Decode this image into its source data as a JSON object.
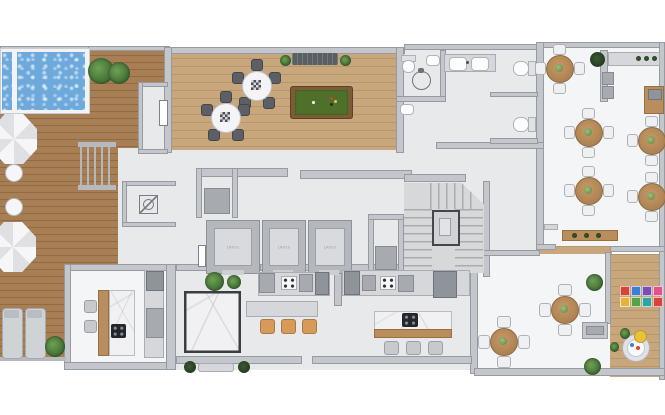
{
  "title": "Residential amenity floor plan",
  "elevator": {
    "label": "LRIOS",
    "count": 3
  },
  "palette": {
    "background": "#ffffff",
    "wall": "#c3c6cb",
    "floor_gray": "#e8e9eb",
    "floor_white": "#f4f5f7",
    "deck_wood": "#a87e55",
    "light_wood": "#c9a77c",
    "pool_water": "#6ea9dc",
    "billiard_felt": "#4e702a",
    "stool_orange": "#d79a58",
    "plant_green": "#3f6b33",
    "marble": "#f1f1f3"
  },
  "icons": [
    "pool",
    "umbrella-icon",
    "lounger-icon",
    "plant-icon",
    "billiard-table-icon",
    "dining-table-icon",
    "elevator-icon",
    "stairs-icon",
    "wheelchair-icon",
    "toilet-icon",
    "sink-icon",
    "cooktop-icon",
    "floor-drain-icon",
    "play-mat-icon"
  ],
  "play_mat_colors": [
    "#d94436",
    "#3f7fd1",
    "#7a4fb5",
    "#e2528f",
    "#e8b23a",
    "#58a246",
    "#2ea3a0"
  ]
}
